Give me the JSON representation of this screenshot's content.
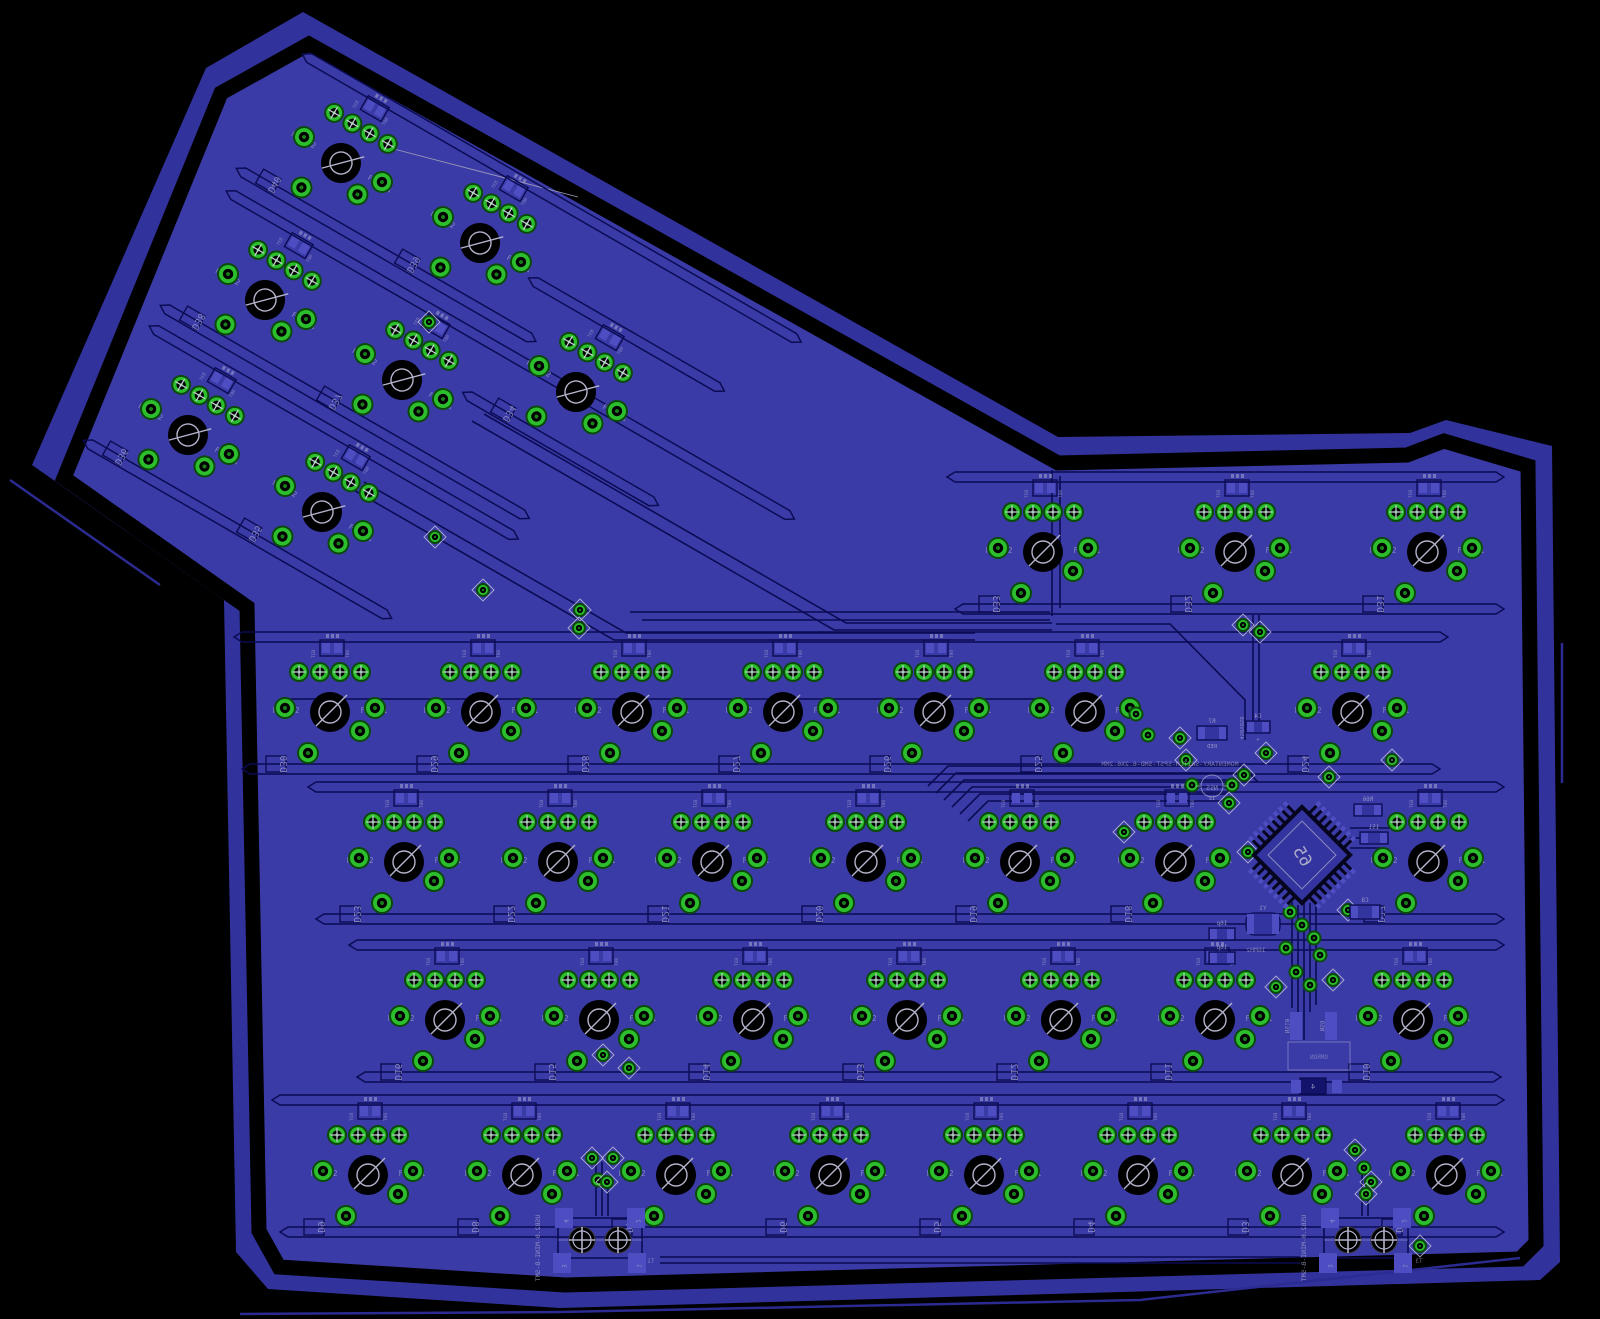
{
  "colors": {
    "background": "#000000",
    "board_band": "#32329C",
    "board_fill": "#3B3BA8",
    "trace": "#0B0B54",
    "trace_soft": "#14146A",
    "silkscreen": "#A6A6CC",
    "pad_green": "#2CBE2C",
    "pad_green_dark": "#0A4A0A",
    "pad_hole": "#000000",
    "pad_speckle": "#1E8A1E",
    "smt_pad": "#4E4EC2",
    "hole_symbol": "#B3B3CC",
    "stray_line": "#2B2B92",
    "mcu_body": "#3434A0"
  },
  "board": {
    "outer_outline": [
      [
        303,
        12
      ],
      [
        1058,
        437
      ],
      [
        1410,
        433
      ],
      [
        1446,
        420
      ],
      [
        1552,
        446
      ],
      [
        1560,
        1262
      ],
      [
        1540,
        1280
      ],
      [
        560,
        1308
      ],
      [
        268,
        1289
      ],
      [
        236,
        1252
      ],
      [
        224,
        600
      ],
      [
        32,
        465
      ],
      [
        206,
        68
      ]
    ],
    "gap_outline": [
      [
        309,
        44
      ],
      [
        1058,
        463
      ],
      [
        1407,
        455
      ],
      [
        1444,
        441
      ],
      [
        1528,
        466
      ],
      [
        1536,
        1243
      ],
      [
        1520,
        1259
      ],
      [
        565,
        1285
      ],
      [
        279,
        1267
      ],
      [
        259,
        1231
      ],
      [
        247,
        607
      ],
      [
        64,
        478
      ],
      [
        221,
        93
      ]
    ],
    "stray_lines": [
      [
        [
          240,
          1314
        ],
        [
          560,
          1312
        ],
        [
          1140,
          1300
        ],
        [
          1520,
          1258
        ]
      ],
      [
        [
          1562,
          643
        ],
        [
          1562,
          783
        ]
      ],
      [
        [
          10,
          480
        ],
        [
          160,
          585
        ]
      ]
    ]
  },
  "silkscreen": {
    "fxpin_left": "FXPIN2",
    "fxpin_right": "FXPIN1",
    "diode_tag_left": "B3T",
    "diode_tag_right": "80T",
    "momentary_text": "MOMENTARY-SWITCH-SPST-SMD-6.2X6.2MM",
    "usb_text": "USB2.0-MINI-B-SMT",
    "mcu_label": "65"
  },
  "switch_rows": [
    {
      "y": 552,
      "xs": [
        1043,
        1235,
        1427
      ],
      "labels": [
        "D33",
        "D32",
        "D31"
      ]
    },
    {
      "y": 712,
      "xs": [
        330,
        481,
        632,
        783,
        934,
        1085,
        1352
      ],
      "labels": [
        "D30",
        "D29",
        "D28",
        "D27",
        "D26",
        "D25",
        "D24"
      ]
    },
    {
      "y": 862,
      "xs": [
        404,
        558,
        712,
        866,
        1020,
        1175,
        1428
      ],
      "labels": [
        "D23",
        "D22",
        "D21",
        "D20",
        "D19",
        "D18",
        "D17"
      ]
    },
    {
      "y": 1020,
      "xs": [
        445,
        599,
        753,
        907,
        1061,
        1215,
        1413
      ],
      "labels": [
        "D16",
        "D15",
        "D14",
        "D13",
        "D12",
        "D11",
        "D10"
      ]
    },
    {
      "y": 1175,
      "xs": [
        368,
        522,
        676,
        830,
        984,
        1138,
        1292,
        1446
      ],
      "labels": [
        "D9",
        "D8",
        "D7",
        "D6",
        "D5",
        "D4",
        "D3",
        "D2"
      ]
    }
  ],
  "arm": {
    "angle": 30,
    "switches": [
      {
        "x": 341,
        "y": 163,
        "label": "D40"
      },
      {
        "x": 480,
        "y": 243,
        "label": "D39"
      },
      {
        "x": 265,
        "y": 300,
        "label": "D38"
      },
      {
        "x": 402,
        "y": 380,
        "label": "D37"
      },
      {
        "x": 188,
        "y": 435,
        "label": "D36"
      },
      {
        "x": 322,
        "y": 512,
        "label": "D35"
      },
      {
        "x": 576,
        "y": 392,
        "label": "D34"
      }
    ],
    "channels": [
      {
        "x": 341,
        "y": 163,
        "u1": -80,
        "u2": 480,
        "lower": false
      },
      {
        "x": 341,
        "y": 163,
        "u1": -80,
        "u2": 250,
        "lower": true
      },
      {
        "x": 265,
        "y": 300,
        "u1": -80,
        "u2": 560,
        "lower": false
      },
      {
        "x": 265,
        "y": 300,
        "u1": -80,
        "u2": 330,
        "lower": true
      },
      {
        "x": 188,
        "y": 435,
        "u1": -80,
        "u2": 330,
        "lower": false
      },
      {
        "x": 188,
        "y": 435,
        "u1": -80,
        "u2": 260,
        "lower": true
      },
      {
        "x": 576,
        "y": 392,
        "u1": -90,
        "u2": 120,
        "lower": false
      },
      {
        "x": 576,
        "y": 392,
        "u1": -90,
        "u2": 120,
        "lower": true
      }
    ],
    "airwire": [
      [
        390,
        148
      ],
      [
        578,
        197
      ]
    ]
  },
  "mcu": {
    "x": 1302,
    "y": 855,
    "rotation": 45,
    "label": "65"
  },
  "usb_connectors": [
    {
      "x": 600,
      "y": 1240,
      "label": "USB2.0-MINI-B-SMT",
      "pin_labels": [
        "4",
        "2",
        "3",
        "1"
      ]
    },
    {
      "x": 1366,
      "y": 1240,
      "label": "USB2.0-MINI-B-SMT",
      "pin_labels": [
        "4",
        "2",
        "3",
        "1"
      ]
    }
  ],
  "components": [
    {
      "x": 1212,
      "y": 733,
      "w": 30,
      "h": 14,
      "label": "R7",
      "sub": "RED"
    },
    {
      "x": 1258,
      "y": 727,
      "w": 24,
      "h": 12,
      "label": "C4",
      "sub": "+"
    },
    {
      "x": 1222,
      "y": 934,
      "w": 26,
      "h": 12,
      "label": "16p",
      "sub": ""
    },
    {
      "x": 1222,
      "y": 958,
      "w": 26,
      "h": 12,
      "label": "16p",
      "sub": ""
    },
    {
      "x": 1263,
      "y": 924,
      "w": 34,
      "h": 22,
      "label": "Y1",
      "sub": ""
    },
    {
      "x": 1368,
      "y": 810,
      "w": 28,
      "h": 12,
      "label": "R66",
      "sub": ""
    },
    {
      "x": 1374,
      "y": 838,
      "w": 28,
      "h": 12,
      "label": "151",
      "sub": ""
    },
    {
      "x": 1365,
      "y": 912,
      "w": 30,
      "h": 14,
      "label": "C8",
      "sub": ""
    }
  ],
  "vertical_components": [
    {
      "x": 1296,
      "y": 1026,
      "label": "NS10"
    },
    {
      "x": 1331,
      "y": 1026,
      "label": "NS9"
    }
  ],
  "button": {
    "x": 1288,
    "y": 1042,
    "w": 62,
    "h": 28,
    "label": "OMRON",
    "pad_label": "4"
  },
  "led": {
    "x": 1212,
    "y": 786,
    "label": "N55",
    "sub": "12"
  },
  "texts": [
    {
      "x": 1170,
      "y": 766,
      "text": "MOMENTARY-SWITCH-SPST-SMD-6.2X6.2MM",
      "size": 6.5,
      "rot": 0,
      "mirror": true
    },
    {
      "x": 1256,
      "y": 952,
      "text": "16MHz",
      "size": 6.5,
      "rot": 0,
      "mirror": true
    },
    {
      "x": 1240,
      "y": 728,
      "text": "450V05B",
      "size": 5.5,
      "rot": 90,
      "mirror": true
    },
    {
      "x": 651,
      "y": 1263,
      "text": "T1",
      "size": 6,
      "rot": 0,
      "mirror": true
    },
    {
      "x": 1419,
      "y": 1263,
      "text": "T3",
      "size": 6,
      "rot": 0,
      "mirror": true
    }
  ],
  "diamond_pads": [
    [
      435,
      537
    ],
    [
      483,
      590
    ],
    [
      580,
      610
    ],
    [
      579,
      628
    ],
    [
      1243,
      625
    ],
    [
      1260,
      632
    ],
    [
      592,
      1158
    ],
    [
      613,
      1158
    ],
    [
      607,
      1182
    ],
    [
      1355,
      1150
    ],
    [
      1371,
      1182
    ],
    [
      1366,
      1194
    ],
    [
      1392,
      760
    ],
    [
      1266,
      753
    ],
    [
      1329,
      777
    ],
    [
      1180,
      738
    ],
    [
      1186,
      760
    ],
    [
      1244,
      775
    ],
    [
      1229,
      803
    ],
    [
      1248,
      852
    ],
    [
      1124,
      832
    ],
    [
      1420,
      1246
    ],
    [
      603,
      1055
    ],
    [
      629,
      1068
    ],
    [
      1333,
      980
    ],
    [
      1276,
      987
    ],
    [
      1348,
      910
    ],
    [
      429,
      322
    ]
  ],
  "vias": [
    [
      1290,
      912
    ],
    [
      1302,
      925
    ],
    [
      1314,
      938
    ],
    [
      1286,
      948
    ],
    [
      1320,
      955
    ],
    [
      1296,
      972
    ],
    [
      1310,
      985
    ],
    [
      1148,
      735
    ],
    [
      1136,
      714
    ],
    [
      598,
      1180
    ],
    [
      1364,
      1168
    ],
    [
      1192,
      785
    ],
    [
      1232,
      785
    ]
  ],
  "decor_traces": [
    [
      [
        352,
        489
      ],
      [
        614,
        640
      ],
      [
        975,
        640
      ]
    ],
    [
      [
        364,
        482
      ],
      [
        626,
        633
      ],
      [
        975,
        633
      ]
    ],
    [
      [
        472,
        421
      ],
      [
        834,
        630
      ],
      [
        1052,
        630
      ]
    ],
    [
      [
        484,
        414
      ],
      [
        846,
        623
      ],
      [
        1052,
        623
      ]
    ],
    [
      [
        630,
        612
      ],
      [
        1050,
        612
      ]
    ],
    [
      [
        642,
        620
      ],
      [
        1050,
        620
      ]
    ],
    [
      [
        1052,
        470
      ],
      [
        1052,
        616
      ]
    ],
    [
      [
        1060,
        476
      ],
      [
        1060,
        608
      ]
    ],
    [
      [
        1056,
        624
      ],
      [
        1170,
        624
      ],
      [
        1245,
        700
      ],
      [
        1245,
        740
      ]
    ],
    [
      [
        285,
        699
      ],
      [
        1040,
        699
      ]
    ],
    [
      [
        928,
        786
      ],
      [
        948,
        766
      ],
      [
        1242,
        766
      ],
      [
        1258,
        782
      ]
    ],
    [
      [
        936,
        793
      ],
      [
        956,
        773
      ],
      [
        1238,
        773
      ]
    ],
    [
      [
        944,
        800
      ],
      [
        964,
        780
      ],
      [
        1234,
        780
      ]
    ],
    [
      [
        952,
        807
      ],
      [
        972,
        787
      ],
      [
        1230,
        787
      ]
    ],
    [
      [
        960,
        814
      ],
      [
        980,
        794
      ],
      [
        1226,
        794
      ]
    ],
    [
      [
        968,
        821
      ],
      [
        988,
        801
      ],
      [
        1222,
        801
      ]
    ],
    [
      [
        1292,
        902
      ],
      [
        1292,
        1008
      ]
    ],
    [
      [
        1298,
        905
      ],
      [
        1298,
        1012
      ]
    ],
    [
      [
        1304,
        900
      ],
      [
        1304,
        1040
      ]
    ],
    [
      [
        1310,
        903
      ],
      [
        1310,
        1012
      ]
    ],
    [
      [
        1316,
        906
      ],
      [
        1316,
        1005
      ]
    ],
    [
      [
        1350,
        828
      ],
      [
        1392,
        828
      ],
      [
        1392,
        818
      ]
    ],
    [
      [
        1350,
        838
      ],
      [
        1388,
        838
      ]
    ],
    [
      [
        1350,
        848
      ],
      [
        1384,
        848
      ]
    ],
    [
      [
        596,
        1162
      ],
      [
        596,
        1216
      ]
    ],
    [
      [
        602,
        1162
      ],
      [
        602,
        1216
      ]
    ],
    [
      [
        608,
        1186
      ],
      [
        608,
        1216
      ]
    ],
    [
      [
        1362,
        1170
      ],
      [
        1362,
        1216
      ]
    ],
    [
      [
        1368,
        1186
      ],
      [
        1368,
        1216
      ]
    ],
    [
      [
        660,
        1257
      ],
      [
        1300,
        1257
      ]
    ],
    [
      [
        660,
        1263
      ],
      [
        1300,
        1263
      ]
    ],
    [
      [
        1253,
        615
      ],
      [
        1253,
        728
      ]
    ],
    [
      [
        1259,
        615
      ],
      [
        1259,
        722
      ]
    ]
  ]
}
